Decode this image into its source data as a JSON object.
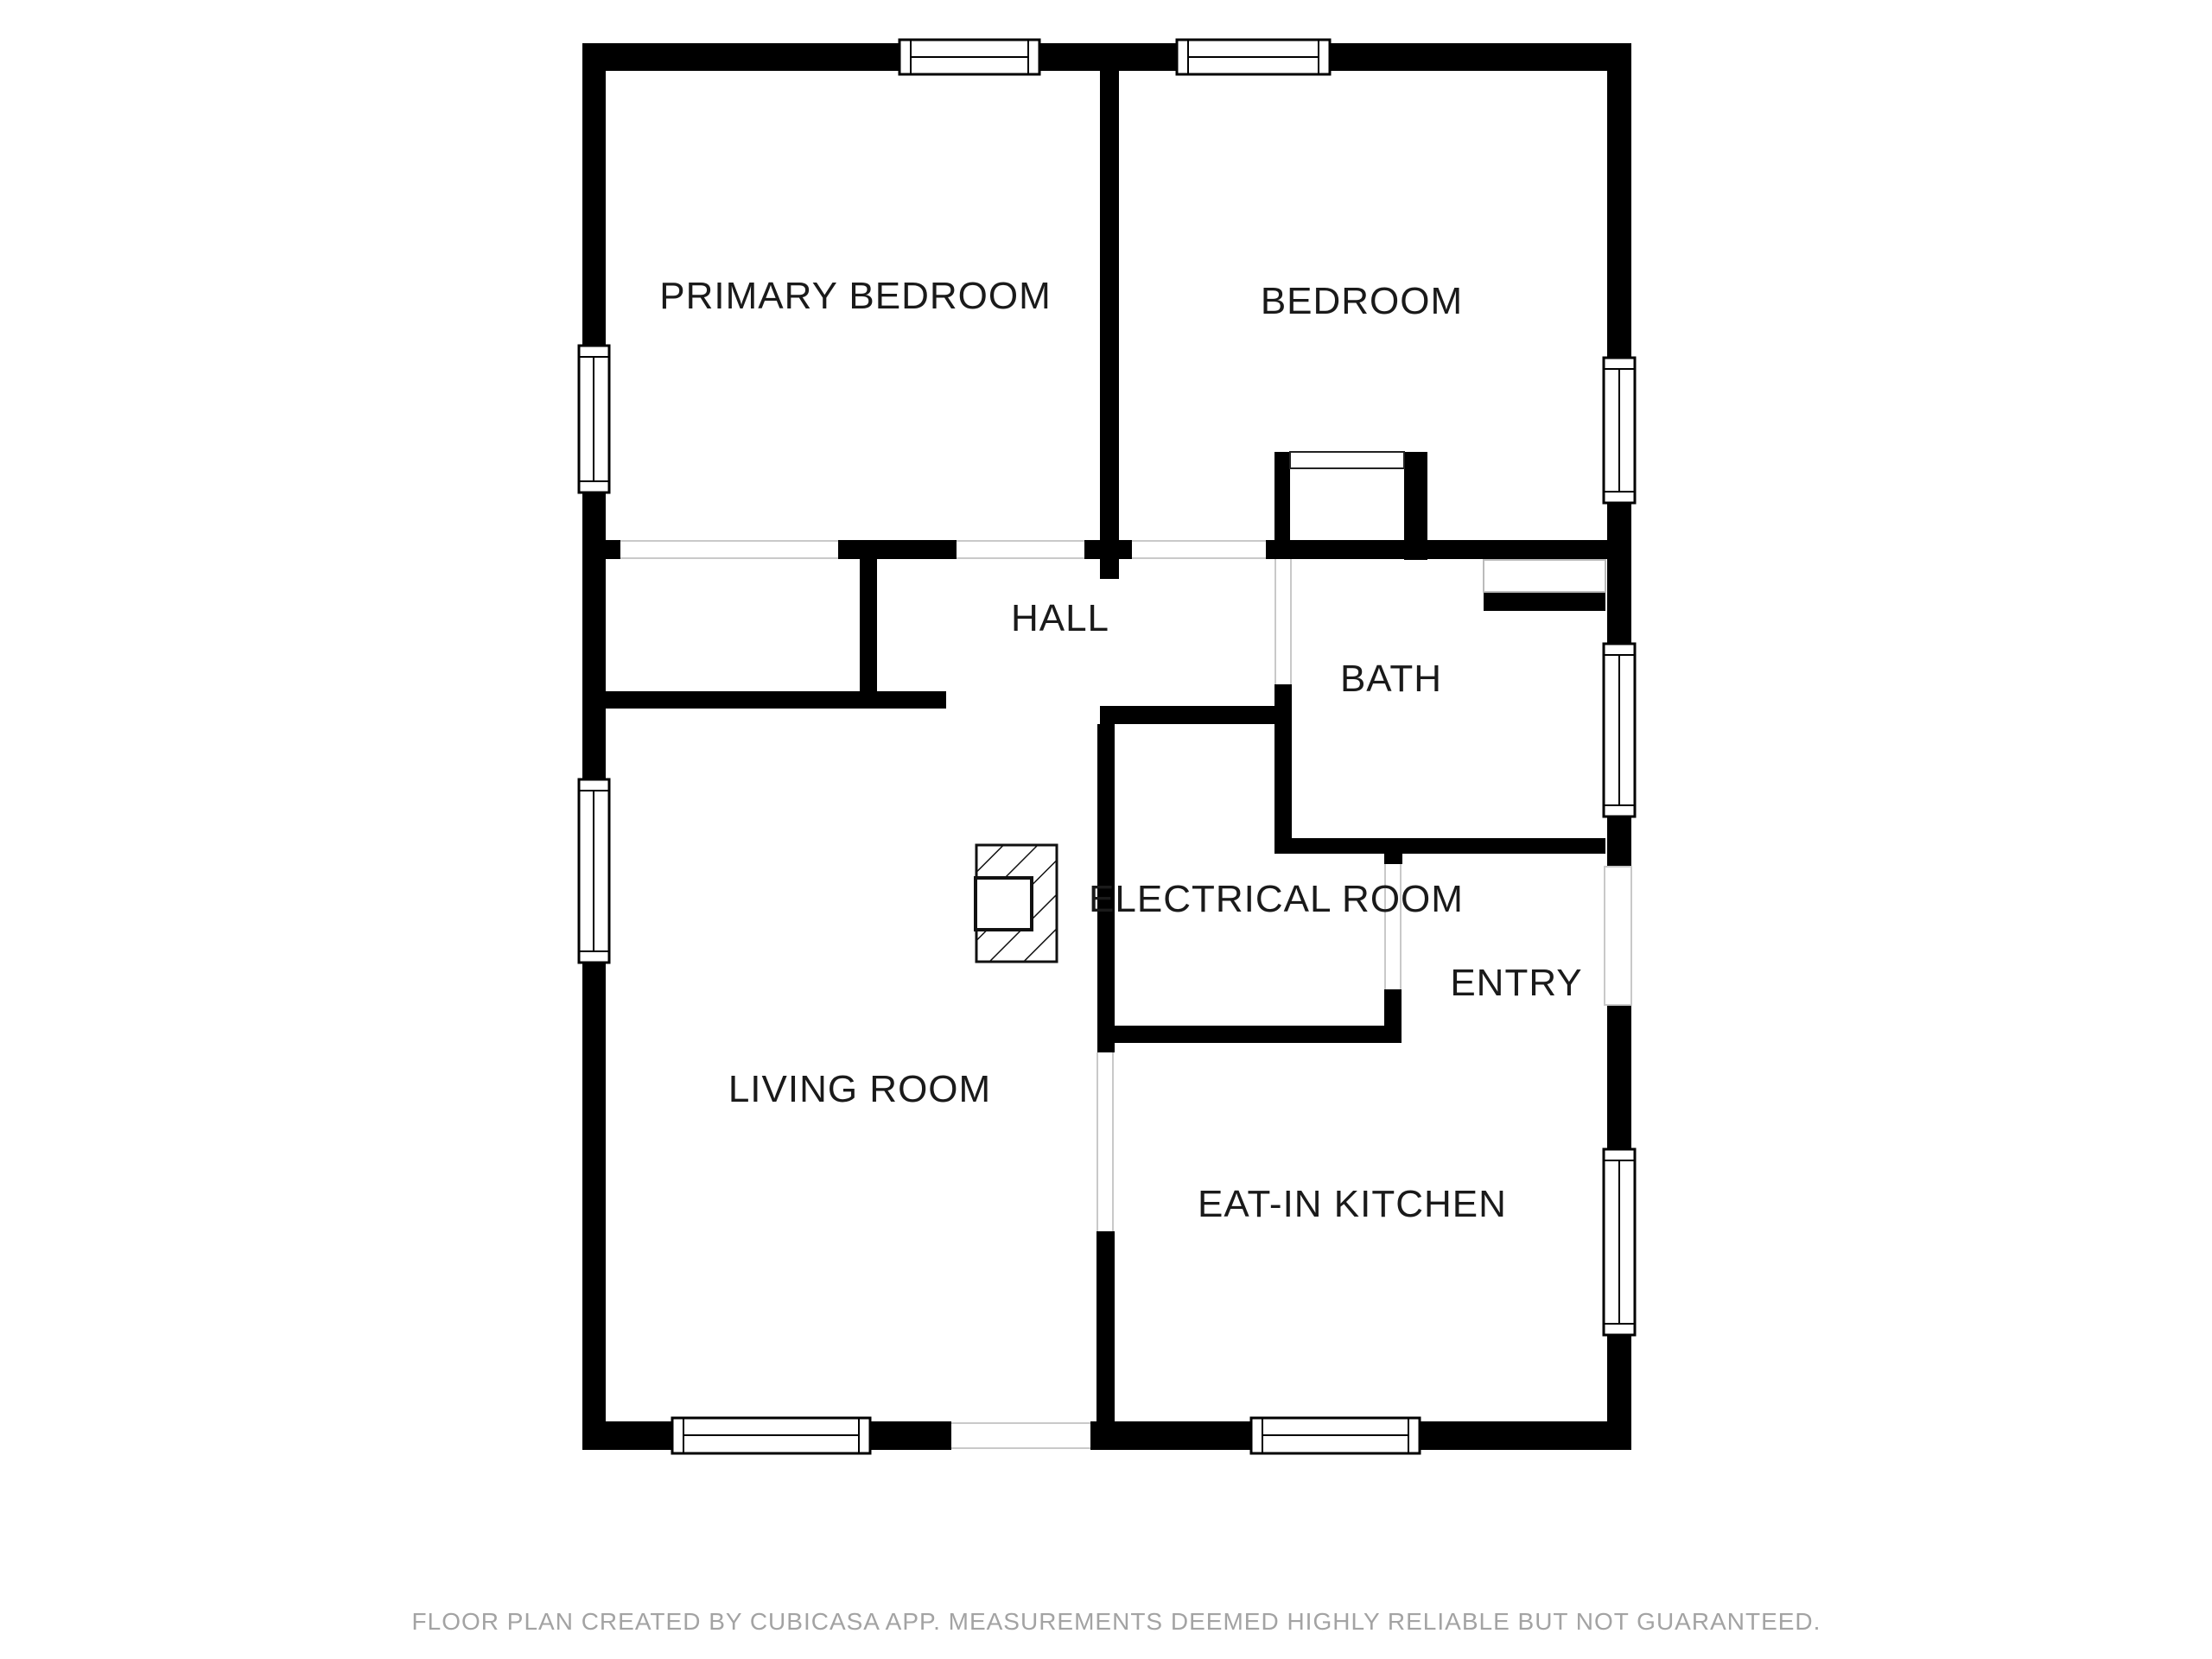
{
  "floor_plan": {
    "rooms": [
      {
        "name": "primary-bedroom",
        "label": "PRIMARY BEDROOM"
      },
      {
        "name": "bedroom",
        "label": "BEDROOM"
      },
      {
        "name": "hall",
        "label": "HALL"
      },
      {
        "name": "bath",
        "label": "BATH"
      },
      {
        "name": "electrical-room",
        "label": "ELECTRICAL ROOM"
      },
      {
        "name": "entry",
        "label": "ENTRY"
      },
      {
        "name": "living-room",
        "label": "LIVING ROOM"
      },
      {
        "name": "eat-in-kitchen",
        "label": "EAT-IN KITCHEN"
      }
    ],
    "footer": "FLOOR PLAN CREATED BY CUBICASA APP. MEASUREMENTS DEEMED HIGHLY RELIABLE BUT NOT GUARANTEED.",
    "colors": {
      "background": "#ffffff",
      "wall": "#000000",
      "label_text": "#1a1a1a",
      "footer_text": "#a3a3a3",
      "opening_line": "#c9c9c9",
      "niche_line": "#bbbbbb"
    }
  }
}
